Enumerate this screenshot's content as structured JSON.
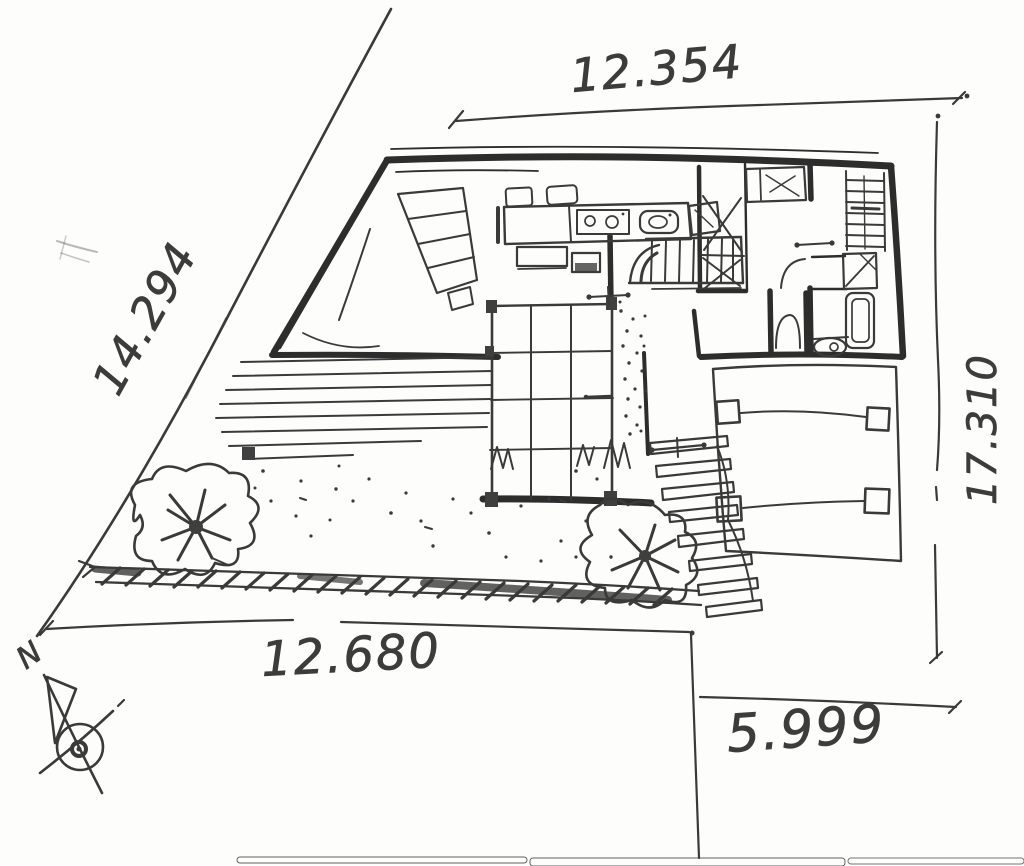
{
  "document": {
    "kind_label": "site-plan-sketch"
  },
  "dimensions": {
    "top": "12.354",
    "left": "14.294",
    "right": "17.310",
    "bottom": "12.680",
    "bottom_right": "5.999"
  },
  "compass": {
    "north_label": "N"
  },
  "icons": {
    "north_compass": "crossed-circle-with-arrow"
  },
  "colors": {
    "ink": "#3a3a3a",
    "wall_ink": "#2d2d2d",
    "paper": "#fdfdfb",
    "scan_streak": "#9a9a92"
  }
}
